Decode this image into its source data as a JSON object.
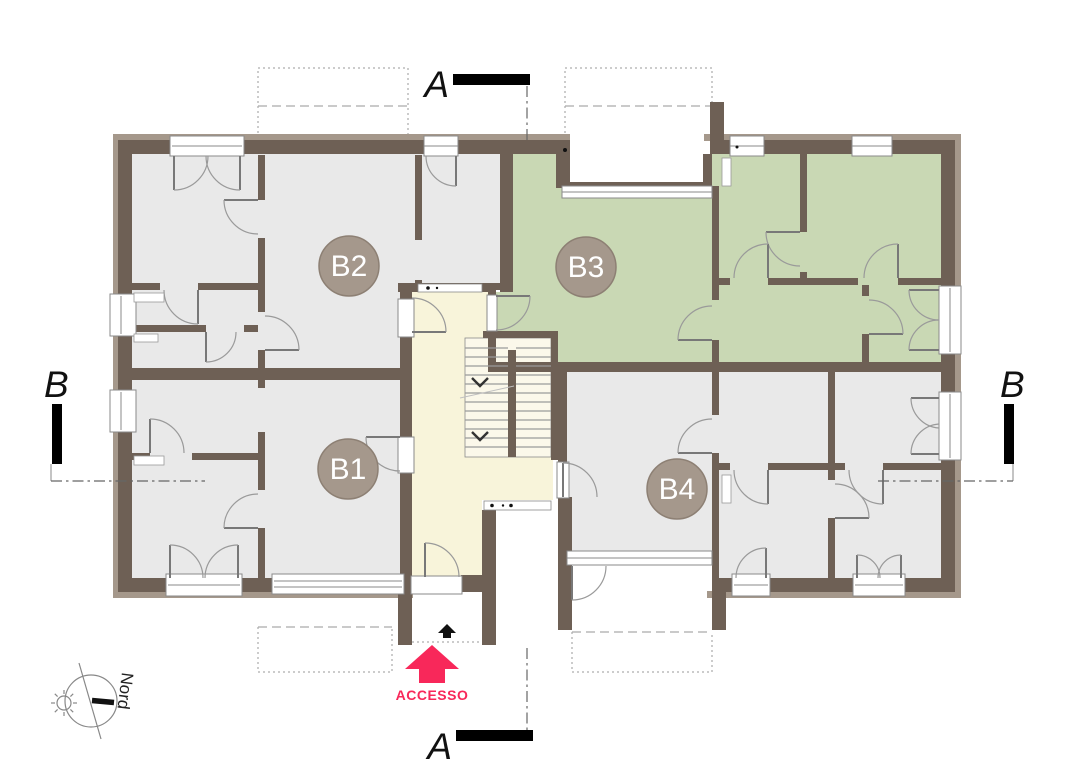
{
  "plan": {
    "units": [
      {
        "id": "B1",
        "label": "B1",
        "highlighted": false
      },
      {
        "id": "B2",
        "label": "B2",
        "highlighted": false
      },
      {
        "id": "B3",
        "label": "B3",
        "highlighted": true
      },
      {
        "id": "B4",
        "label": "B4",
        "highlighted": false
      }
    ],
    "sections": {
      "a": "A",
      "b": "B"
    },
    "north_label": "Nord",
    "access_label": "ACCESSO"
  },
  "colors": {
    "wall": "#6E6055",
    "wall_light": "#A5988B",
    "room": "#E9E9E9",
    "room_highlight": "#C9D8B4",
    "hall": "#F8F4DA",
    "stair": "#FBF8EA",
    "accent": "#F8285A",
    "badge": "#A5988C",
    "badge_text": "#FFFFFF",
    "line": "#8E8E8E"
  }
}
